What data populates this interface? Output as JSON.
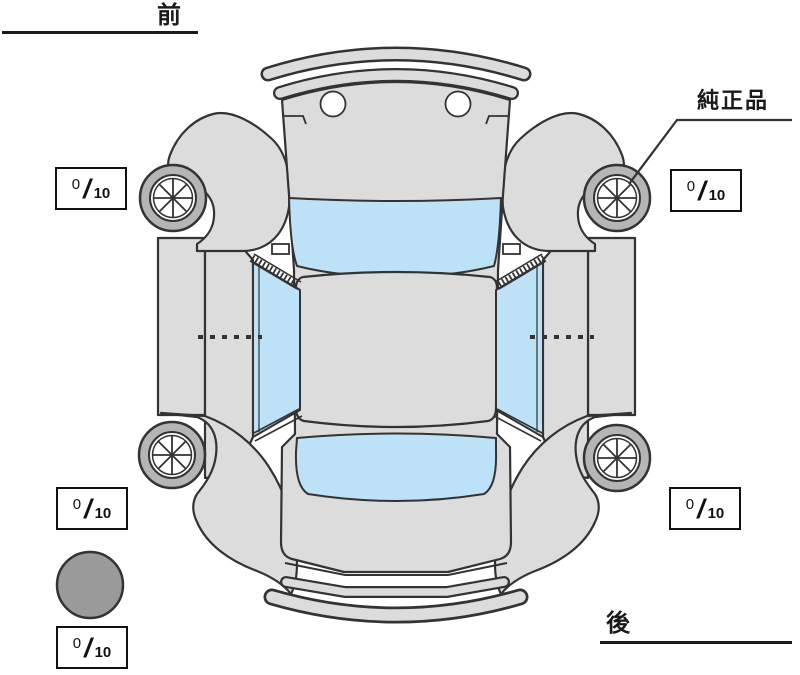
{
  "diagram": {
    "front_label": "前",
    "rear_label": "後",
    "genuine_part_label": "純正品"
  },
  "tread_scores": {
    "front_left": {
      "value": "0",
      "slash": "/",
      "max": "10"
    },
    "front_right": {
      "value": "0",
      "slash": "/",
      "max": "10"
    },
    "rear_left": {
      "value": "0",
      "slash": "/",
      "max": "10"
    },
    "rear_right": {
      "value": "0",
      "slash": "/",
      "max": "10"
    },
    "spare": {
      "value": "0",
      "slash": "/",
      "max": "10"
    }
  },
  "colors": {
    "body_gray": "#dcdcdc",
    "window_blue": "#bde2f7",
    "outline": "#333333",
    "tire_gray": "#b5b5b5",
    "spare_gray": "#9a9a9a",
    "label_black": "#1a1a1a"
  }
}
